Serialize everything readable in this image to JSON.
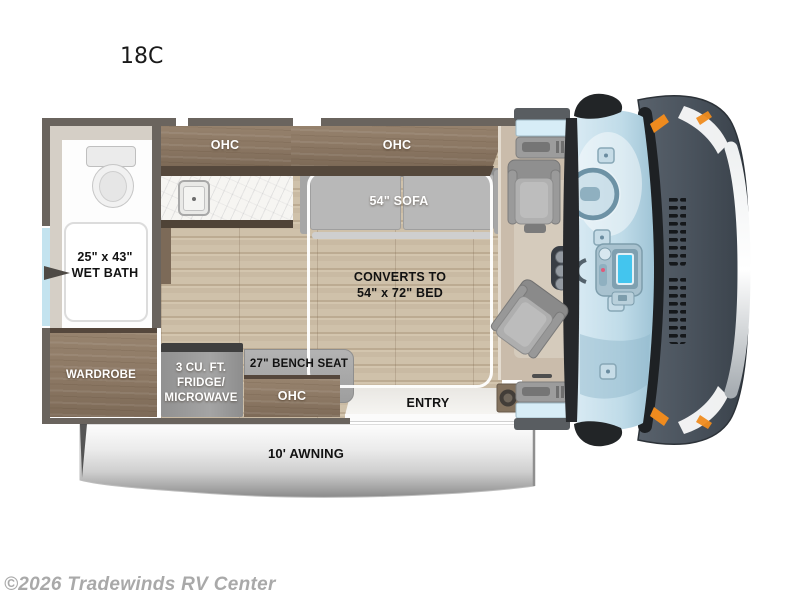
{
  "title": "18C",
  "watermark": "©2026 Tradewinds RV Center",
  "labels": {
    "kitchen_ohc": "OHC",
    "sofa_ohc": "OHC",
    "sofa": "54\" SOFA",
    "bed_line1": "CONVERTS TO",
    "bed_line2": "54\" x 72\" BED",
    "wet_bath_line1": "25\" x 43\"",
    "wet_bath_line2": "WET BATH",
    "wardrobe": "WARDROBE",
    "fridge_line1": "3 CU. FT.",
    "fridge_line2": "FRIDGE/",
    "fridge_line3": "MICROWAVE",
    "bench_seat": "27\" BENCH SEAT",
    "bench_ohc": "OHC",
    "entry": "ENTRY",
    "awning": "10' AWNING"
  },
  "colors": {
    "wall": "#6a645e",
    "wood_floor": "#c9baa3",
    "cabinet_wood": "#8b7763",
    "cabinet_edge": "#55483c",
    "sofa_gray": "#b5b5b5",
    "counter_marble": "#f6f5f2",
    "awning_silver": "#c9c9c9",
    "van_body": "#49525c",
    "windshield_blue": "#bfdbe8",
    "accent_orange": "#ef8b1e",
    "screen_cyan": "#43c5ee"
  }
}
